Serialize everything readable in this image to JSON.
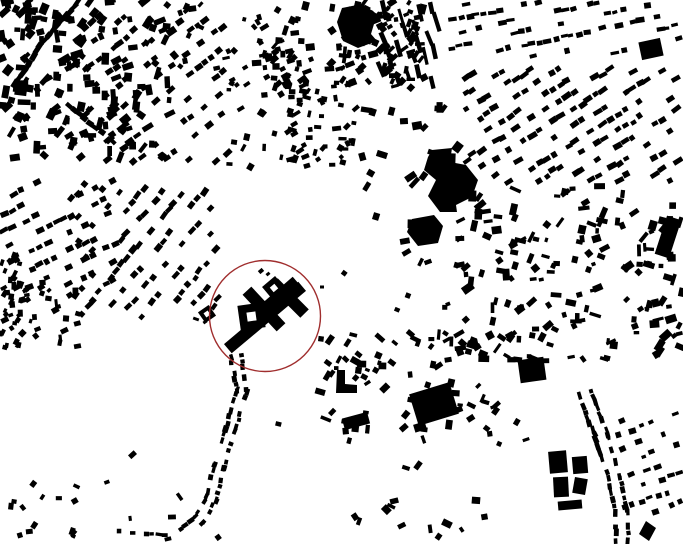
{
  "canvas": {
    "width": 683,
    "height": 544,
    "background": "#ffffff",
    "building_color": "#000000"
  },
  "annotation_circle": {
    "cx": 265,
    "cy": 316,
    "r": 55.5,
    "color": "#a02e2e",
    "stroke_width": 1.4
  },
  "monument": {
    "bars": [
      [
        265,
        317.5,
        97,
        12,
        -40
      ],
      [
        274,
        301,
        60,
        12,
        -41
      ],
      [
        264,
        309,
        50,
        12,
        47
      ],
      [
        289,
        298,
        44,
        12,
        45
      ]
    ],
    "rings": [
      [
        251.5,
        316.5,
        25,
        9,
        -8
      ],
      [
        274,
        288,
        17,
        6,
        -40
      ],
      [
        207,
        314,
        13,
        5,
        -35
      ]
    ],
    "tiny_marks": [
      [
        261,
        271,
        5,
        4,
        -40
      ],
      [
        268,
        274,
        4,
        3,
        -40
      ],
      [
        196,
        319,
        6,
        3,
        20
      ],
      [
        322,
        287,
        4,
        3,
        0
      ],
      [
        205,
        322,
        4,
        3,
        -35
      ]
    ]
  },
  "landmark_blocks": [
    {
      "name": "dark-block-northeast",
      "cx": 651,
      "cy": 49,
      "w": 22,
      "h": 18,
      "angle": -12
    },
    {
      "name": "east-bar-building",
      "cx": 668,
      "cy": 237,
      "w": 15,
      "h": 40,
      "angle": 18
    },
    {
      "name": "southeast-square-hall",
      "cx": 532,
      "cy": 370,
      "w": 26,
      "h": 23,
      "angle": -8
    },
    {
      "name": "se-cross-block-a",
      "cx": 558,
      "cy": 462,
      "w": 18,
      "h": 22,
      "angle": -5
    },
    {
      "name": "se-cross-block-b",
      "cx": 580,
      "cy": 465,
      "w": 15,
      "h": 17,
      "angle": -5
    },
    {
      "name": "se-cross-block-c",
      "cx": 561,
      "cy": 487,
      "w": 15,
      "h": 20,
      "angle": -3
    },
    {
      "name": "se-cross-block-d",
      "cx": 580,
      "cy": 486,
      "w": 13,
      "h": 16,
      "angle": 10
    },
    {
      "name": "se-cross-block-e",
      "cx": 570,
      "cy": 505,
      "w": 24,
      "h": 9,
      "angle": -5
    },
    {
      "name": "south-hall",
      "cx": 434,
      "cy": 404,
      "w": 42,
      "h": 33,
      "angle": -17
    },
    {
      "name": "south-hall-annex",
      "cx": 420,
      "cy": 427,
      "w": 12,
      "h": 8,
      "angle": -17
    },
    {
      "name": "mid-south-bar",
      "cx": 356,
      "cy": 421,
      "w": 26,
      "h": 12,
      "angle": -15
    }
  ],
  "landmark_polygons": [
    {
      "name": "big-building-north",
      "points": [
        [
          342,
          8
        ],
        [
          362,
          4
        ],
        [
          377,
          14
        ],
        [
          371,
          34
        ],
        [
          377,
          41
        ],
        [
          358,
          48
        ],
        [
          343,
          41
        ],
        [
          337,
          22
        ]
      ]
    },
    {
      "name": "large-hall-center",
      "points": [
        [
          432,
          150
        ],
        [
          452,
          148
        ],
        [
          450,
          162
        ],
        [
          466,
          165
        ],
        [
          478,
          180
        ],
        [
          472,
          197
        ],
        [
          456,
          205
        ],
        [
          457,
          212
        ],
        [
          440,
          212
        ],
        [
          428,
          196
        ],
        [
          436,
          180
        ],
        [
          424,
          170
        ],
        [
          428,
          157
        ]
      ]
    },
    {
      "name": "hall-center-south",
      "points": [
        [
          412,
          219
        ],
        [
          434,
          215
        ],
        [
          443,
          226
        ],
        [
          438,
          243
        ],
        [
          418,
          246
        ],
        [
          407,
          232
        ]
      ]
    },
    {
      "name": "south-diamond",
      "points": [
        [
          646,
          521
        ],
        [
          656,
          528
        ],
        [
          649,
          541
        ],
        [
          639,
          534
        ]
      ]
    },
    {
      "name": "west-l-building",
      "points": [
        [
          337,
          370
        ],
        [
          345,
          370
        ],
        [
          345,
          384
        ],
        [
          357,
          385
        ],
        [
          357,
          393
        ],
        [
          336,
          393
        ]
      ]
    }
  ],
  "clusters": [
    {
      "name": "old-town-northwest",
      "mode": "scatter",
      "seed": 11,
      "rect": [
        0,
        0,
        175,
        158
      ],
      "count": 160,
      "len": [
        5,
        13
      ],
      "wid": [
        4,
        8
      ],
      "angle_base": -45,
      "angle_jitter": 55
    },
    {
      "name": "nw-diagonal-row-a",
      "mode": "strip",
      "seed": 12,
      "path": [
        [
          78,
          2
        ],
        [
          40,
          46
        ],
        [
          16,
          84
        ]
      ],
      "spacing": 6,
      "offset": 2,
      "two_sided": false,
      "len": [
        6,
        11
      ],
      "wid": [
        4,
        6
      ],
      "skip": 0.1
    },
    {
      "name": "nw-diagonal-row-b",
      "mode": "strip",
      "seed": 13,
      "path": [
        [
          58,
          96
        ],
        [
          112,
          142
        ]
      ],
      "spacing": 6.5,
      "offset": 2,
      "two_sided": false,
      "len": [
        6,
        10
      ],
      "wid": [
        4,
        6
      ],
      "skip": 0.15
    },
    {
      "name": "northwest-fan-rows",
      "mode": "rows",
      "seed": 14,
      "rect": [
        82,
        8,
        148,
        158
      ],
      "angle": -38,
      "row_spacing": 17,
      "spacing": 9,
      "len": [
        5,
        9
      ],
      "wid": [
        4,
        6
      ],
      "skip": 0.45
    },
    {
      "name": "north-sparse-arc",
      "mode": "scatter",
      "seed": 15,
      "rect": [
        165,
        0,
        100,
        88
      ],
      "count": 20,
      "len": [
        4,
        8
      ],
      "wid": [
        3,
        6
      ],
      "angle_base": -40,
      "angle_jitter": 45
    },
    {
      "name": "north-center-sparse",
      "mode": "scatter",
      "seed": 16,
      "rect": [
        228,
        42,
        72,
        130
      ],
      "count": 26,
      "len": [
        4,
        8
      ],
      "wid": [
        3,
        6
      ],
      "angle_base": -40,
      "angle_jitter": 50
    },
    {
      "name": "north-village-core",
      "mode": "scatter",
      "seed": 17,
      "rect": [
        256,
        0,
        168,
        88
      ],
      "count": 150,
      "len": [
        4,
        10
      ],
      "wid": [
        3,
        7
      ],
      "angle_base": -42,
      "angle_jitter": 45,
      "gap_x": [
        313,
        327
      ]
    },
    {
      "name": "north-terrace-strips",
      "mode": "rows",
      "seed": 18,
      "rect": [
        376,
        0,
        64,
        92
      ],
      "angle": 72,
      "row_spacing": 11,
      "spacing": 14,
      "len": [
        9,
        20
      ],
      "wid": [
        3,
        5
      ],
      "skip": 0.35
    },
    {
      "name": "north-village-south",
      "mode": "scatter",
      "seed": 19,
      "rect": [
        286,
        84,
        72,
        82
      ],
      "count": 55,
      "len": [
        4,
        9
      ],
      "wid": [
        3,
        6
      ],
      "angle_base": -40,
      "angle_jitter": 60
    },
    {
      "name": "northeast-band-rows",
      "mode": "rows",
      "seed": 20,
      "rect": [
        445,
        0,
        238,
        58
      ],
      "angle": -12,
      "row_spacing": 13,
      "spacing": 8,
      "len": [
        5,
        9
      ],
      "wid": [
        3,
        6
      ],
      "skip": 0.5
    },
    {
      "name": "northeast-district-rows",
      "mode": "rows",
      "seed": 21,
      "rect": [
        462,
        66,
        221,
        118
      ],
      "angle": -32,
      "row_spacing": 14,
      "spacing": 8.5,
      "len": [
        5,
        10
      ],
      "wid": [
        4,
        6
      ],
      "skip": 0.42
    },
    {
      "name": "center-east-sparse",
      "mode": "scatter",
      "seed": 22,
      "rect": [
        362,
        92,
        100,
        150
      ],
      "count": 22,
      "len": [
        6,
        13
      ],
      "wid": [
        4,
        9
      ],
      "angle_base": -30,
      "angle_jitter": 60
    },
    {
      "name": "east-district-jumble",
      "mode": "scatter",
      "seed": 23,
      "rect": [
        458,
        185,
        225,
        175
      ],
      "count": 170,
      "len": [
        4,
        12
      ],
      "wid": [
        3,
        8
      ],
      "angle_base": -35,
      "angle_jitter": 60
    },
    {
      "name": "east-mid-scatter",
      "mode": "scatter",
      "seed": 24,
      "rect": [
        455,
        330,
        115,
        80
      ],
      "count": 14,
      "len": [
        4,
        9
      ],
      "wid": [
        3,
        6
      ],
      "angle_base": -20,
      "angle_jitter": 60
    },
    {
      "name": "village-below-center",
      "mode": "scatter",
      "seed": 25,
      "rect": [
        316,
        330,
        150,
        102
      ],
      "count": 58,
      "len": [
        4,
        11
      ],
      "wid": [
        3,
        7
      ],
      "angle_base": -20,
      "angle_jitter": 70
    },
    {
      "name": "south-road-ribbon",
      "mode": "strip",
      "seed": 26,
      "path": [
        [
          236,
          356
        ],
        [
          242,
          390
        ],
        [
          230,
          430
        ],
        [
          219,
          466
        ],
        [
          211,
          498
        ],
        [
          199,
          520
        ],
        [
          184,
          533
        ]
      ],
      "spacing": 5.5,
      "offset": 5,
      "two_sided": true,
      "len": [
        4,
        7
      ],
      "wid": [
        3,
        5
      ],
      "skip": 0.18
    },
    {
      "name": "south-row-west",
      "mode": "strip",
      "seed": 27,
      "path": [
        [
          120,
          532
        ],
        [
          178,
          536
        ]
      ],
      "spacing": 6,
      "offset": 2,
      "two_sided": false,
      "len": [
        4,
        7
      ],
      "wid": [
        3,
        5
      ],
      "skip": 0.35
    },
    {
      "name": "southwest-corner",
      "mode": "scatter",
      "seed": 28,
      "rect": [
        0,
        480,
        80,
        64
      ],
      "count": 14,
      "len": [
        4,
        8
      ],
      "wid": [
        3,
        6
      ],
      "angle_base": -30,
      "angle_jitter": 60
    },
    {
      "name": "west-edge-strip",
      "mode": "scatter",
      "seed": 29,
      "rect": [
        0,
        255,
        24,
        105
      ],
      "count": 28,
      "len": [
        4,
        8
      ],
      "wid": [
        3,
        5
      ],
      "angle_base": -60,
      "angle_jitter": 40
    },
    {
      "name": "west-fan-rows-a",
      "mode": "rows",
      "seed": 30,
      "rect": [
        0,
        172,
        118,
        118
      ],
      "angle": -26,
      "row_spacing": 15,
      "spacing": 8.5,
      "len": [
        5,
        9
      ],
      "wid": [
        4,
        6
      ],
      "skip": 0.45
    },
    {
      "name": "west-fan-rows-b",
      "mode": "rows",
      "seed": 31,
      "rect": [
        66,
        182,
        155,
        140
      ],
      "angle": -50,
      "row_spacing": 16,
      "spacing": 9,
      "len": [
        5,
        9
      ],
      "wid": [
        4,
        6
      ],
      "skip": 0.5
    },
    {
      "name": "west-fan-foot",
      "mode": "scatter",
      "seed": 32,
      "rect": [
        0,
        282,
        92,
        68
      ],
      "count": 36,
      "len": [
        4,
        8
      ],
      "wid": [
        3,
        6
      ],
      "angle_base": -45,
      "angle_jitter": 55
    },
    {
      "name": "southeast-road-ribbon",
      "mode": "strip",
      "seed": 33,
      "path": [
        [
          585,
          393
        ],
        [
          602,
          438
        ],
        [
          614,
          478
        ],
        [
          621,
          512
        ],
        [
          622,
          540
        ]
      ],
      "spacing": 6,
      "offset": 6,
      "two_sided": true,
      "len": [
        4,
        8
      ],
      "wid": [
        3,
        5
      ],
      "skip": 0.2
    },
    {
      "name": "southeast-east-rows",
      "mode": "rows",
      "seed": 34,
      "rect": [
        615,
        408,
        68,
        112
      ],
      "angle": -20,
      "row_spacing": 14,
      "spacing": 9,
      "len": [
        4,
        8
      ],
      "wid": [
        3,
        6
      ],
      "skip": 0.55
    },
    {
      "name": "southeast-west-scatter",
      "mode": "scatter",
      "seed": 35,
      "rect": [
        470,
        388,
        90,
        60
      ],
      "count": 9,
      "len": [
        4,
        9
      ],
      "wid": [
        3,
        6
      ],
      "angle_base": -20,
      "angle_jitter": 60
    },
    {
      "name": "open-field-scatter",
      "mode": "scatter",
      "seed": 36,
      "rect": [
        60,
        360,
        420,
        180
      ],
      "count": 20,
      "len": [
        4,
        9
      ],
      "wid": [
        3,
        6
      ],
      "angle_base": 0,
      "angle_jitter": 90
    },
    {
      "name": "mid-gap-scatter",
      "mode": "scatter",
      "seed": 37,
      "rect": [
        330,
        240,
        130,
        70
      ],
      "count": 9,
      "len": [
        4,
        9
      ],
      "wid": [
        3,
        6
      ],
      "angle_base": -30,
      "angle_jitter": 60
    },
    {
      "name": "bottom-edge-scatter",
      "mode": "scatter",
      "seed": 38,
      "rect": [
        280,
        495,
        220,
        49
      ],
      "count": 8,
      "len": [
        5,
        10
      ],
      "wid": [
        4,
        7
      ],
      "angle_base": -10,
      "angle_jitter": 70
    }
  ]
}
